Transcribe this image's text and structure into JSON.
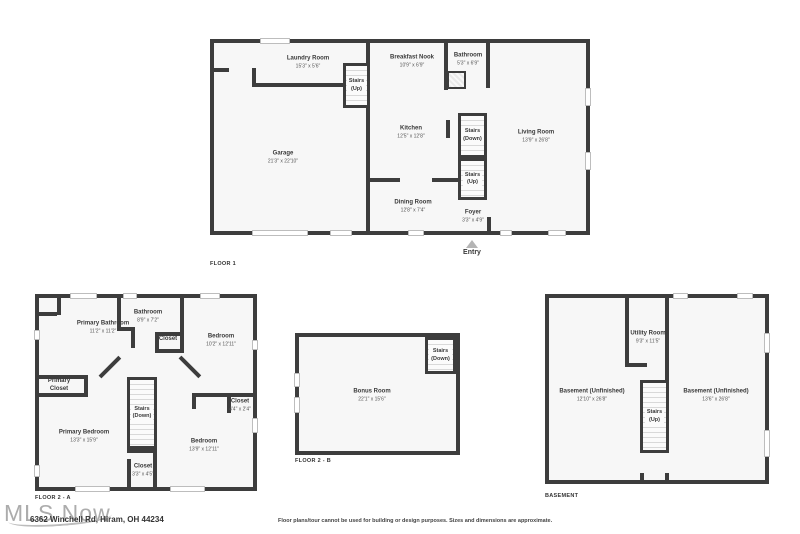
{
  "palette": {
    "wall": "#3d3d3d",
    "floor": "#f7f7f7",
    "background": "#ffffff",
    "window_trim": "#bdbdbd"
  },
  "floor1": {
    "label": "FLOOR 1",
    "entry_label": "Entry",
    "rooms": {
      "laundry": {
        "name": "Laundry Room",
        "dims": "15'3\" x 5'6\""
      },
      "stairs_top": {
        "name": "Stairs",
        "dir": "(Up)"
      },
      "breakfast": {
        "name": "Breakfast Nook",
        "dims": "10'9\" x 6'9\""
      },
      "bathroom": {
        "name": "Bathroom",
        "dims": "5'3\" x 6'9\""
      },
      "garage": {
        "name": "Garage",
        "dims": "21'3\" x 22'10\""
      },
      "kitchen": {
        "name": "Kitchen",
        "dims": "12'5\" x 12'8\""
      },
      "stairs_down": {
        "name": "Stairs",
        "dir": "(Down)"
      },
      "living": {
        "name": "Living Room",
        "dims": "13'9\" x 26'8\""
      },
      "stairs_up": {
        "name": "Stairs",
        "dir": "(Up)"
      },
      "dining": {
        "name": "Dining Room",
        "dims": "12'8\" x 7'4\""
      },
      "foyer": {
        "name": "Foyer",
        "dims": "3'3\" x 4'9\""
      }
    }
  },
  "floor2a": {
    "label": "FLOOR 2 - A",
    "rooms": {
      "primary_bathroom": {
        "name": "Primary Bathroom",
        "dims": "11'2\" x 11'2\""
      },
      "bathroom": {
        "name": "Bathroom",
        "dims": "8'9\" x 7'2\""
      },
      "closet_hall": {
        "name": "Closet"
      },
      "bedroom_top": {
        "name": "Bedroom",
        "dims": "10'2\" x 12'11\""
      },
      "primary_closet": {
        "name": "Primary",
        "name2": "Closet"
      },
      "stairs": {
        "name": "Stairs",
        "dir": "(Down)"
      },
      "closet_small": {
        "name": "Closet",
        "dims": "4'4\" x 2'4\""
      },
      "primary_bedroom": {
        "name": "Primary Bedroom",
        "dims": "13'3\" x 15'9\""
      },
      "bedroom_bottom": {
        "name": "Bedroom",
        "dims": "13'9\" x 12'11\""
      },
      "closet_lower": {
        "name": "Closet",
        "dims": "3'3\" x 4'5\""
      }
    }
  },
  "floor2b": {
    "label": "FLOOR 2 - B",
    "rooms": {
      "bonus": {
        "name": "Bonus Room",
        "dims": "22'1\" x 15'6\""
      },
      "stairs": {
        "name": "Stairs",
        "dir": "(Down)"
      }
    }
  },
  "basement": {
    "label": "BASEMENT",
    "rooms": {
      "utility": {
        "name": "Utility Room",
        "dims": "9'3\" x 11'5\""
      },
      "left": {
        "name": "Basement (Unfinished)",
        "dims": "12'10\" x 26'8\""
      },
      "right": {
        "name": "Basement (Unfinished)",
        "dims": "13'6\" x 26'8\""
      },
      "stairs": {
        "name": "Stairs",
        "dir": "(Up)"
      }
    }
  },
  "footer": {
    "watermark": "MLS Now",
    "address": "6362 Winchell Rd, Hiram, OH 44234",
    "disclaimer": "Floor plans/tour cannot be used for building or design purposes. Sizes and dimensions are approximate."
  }
}
